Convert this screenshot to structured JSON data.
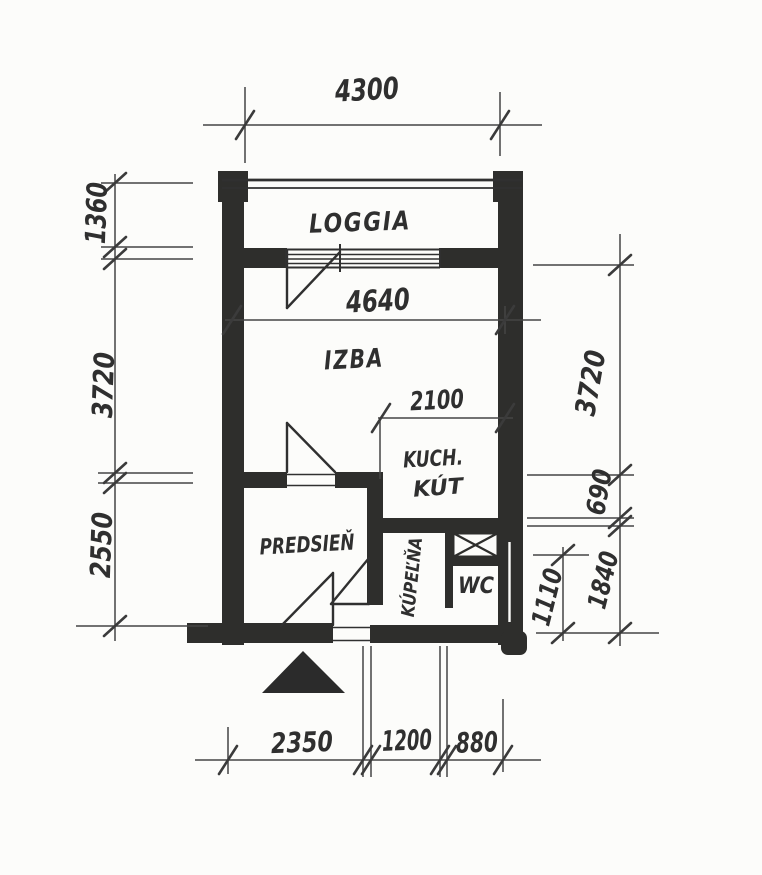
{
  "colors": {
    "paper": "#fcfcfa",
    "ink": "#303030",
    "wall": "#2e2e2c",
    "dim": "#454545"
  },
  "rooms": {
    "loggia": "LOGGIA",
    "izba": "IZBA",
    "kitchen_line1": "KUCH.",
    "kitchen_line2": "KÚT",
    "hall": "PREDSIEŇ",
    "bath": "KÚPEĽŇA",
    "wc": "WC"
  },
  "dims": {
    "top_width": "4300",
    "interior_width": "4640",
    "kitchen_width": "2100",
    "left_loggia_depth": "1360",
    "left_room_depth": "3720",
    "left_hall_depth": "2550",
    "right_room_depth": "3720",
    "right_kitchen_strip": "690",
    "right_wc_depth": "1110",
    "right_bath_depth": "1840",
    "bottom_hall_width": "2350",
    "bottom_bath_width": "1200",
    "bottom_wc_width": "880"
  }
}
